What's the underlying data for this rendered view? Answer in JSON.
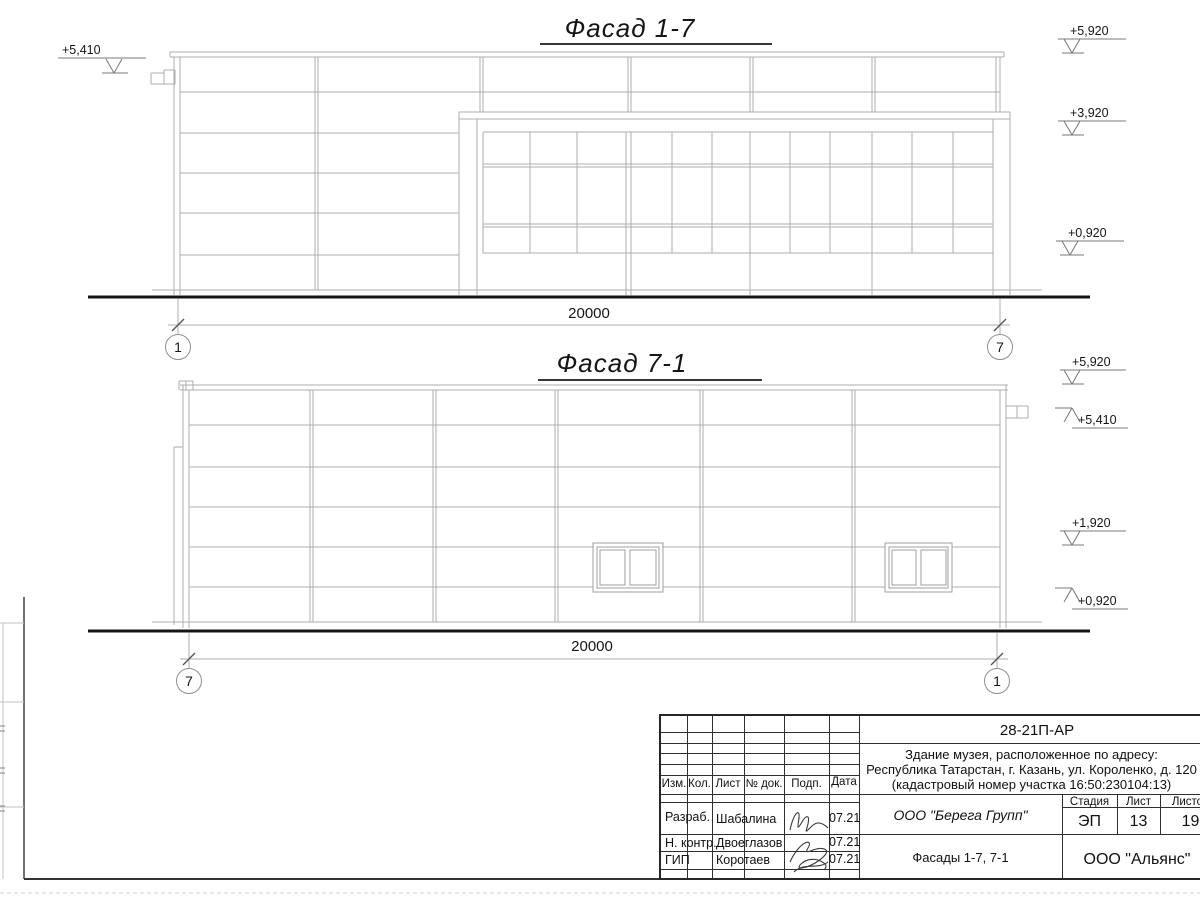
{
  "sheet": {
    "facade17": {
      "title": "Фасад 1-7",
      "dim": "20000",
      "axis_left": "1",
      "axis_right": "7",
      "elev_left": "+5,410",
      "elev_right": [
        "+5,920",
        "+3,920",
        "+0,920"
      ]
    },
    "facade71": {
      "title": "Фасад 7-1",
      "dim": "20000",
      "axis_left": "7",
      "axis_right": "1",
      "elev_right": [
        "+5,920",
        "+5,410",
        "+1,920",
        "+0,920"
      ]
    }
  },
  "titleblock": {
    "code": "28-21П-АР",
    "project_line1": "Здание музея, расположенное по адресу:",
    "project_line2": "Республика Татарстан, г. Казань, ул. Короленко, д. 120",
    "project_line3": "(кадастровый номер участка 16:50:230104:13)",
    "col_headers": [
      "Изм.",
      "Кол.",
      "Лист",
      "№ док.",
      "Подп.",
      "Дата"
    ],
    "rows": [
      {
        "role": "Разраб.",
        "name": "Шабалина",
        "date": "07.21"
      },
      {
        "role": "Н. контр.",
        "name": "Двоеглазов",
        "date": "07.21"
      },
      {
        "role": "ГИП",
        "name": "Коротаев",
        "date": "07.21"
      }
    ],
    "designer": "ООО \"Берега Групп\"",
    "sheet_name": "Фасады 1-7, 7-1",
    "stage_label": "Стадия",
    "sheet_label": "Лист",
    "sheets_label": "Листов",
    "stage": "ЭП",
    "sheet": "13",
    "sheets": "19",
    "client": "ООО \"Альянс\""
  },
  "colors": {
    "thin_line": "#adadad",
    "ground": "#141414",
    "marker": "#787878",
    "frame": "#3a3a3a"
  }
}
